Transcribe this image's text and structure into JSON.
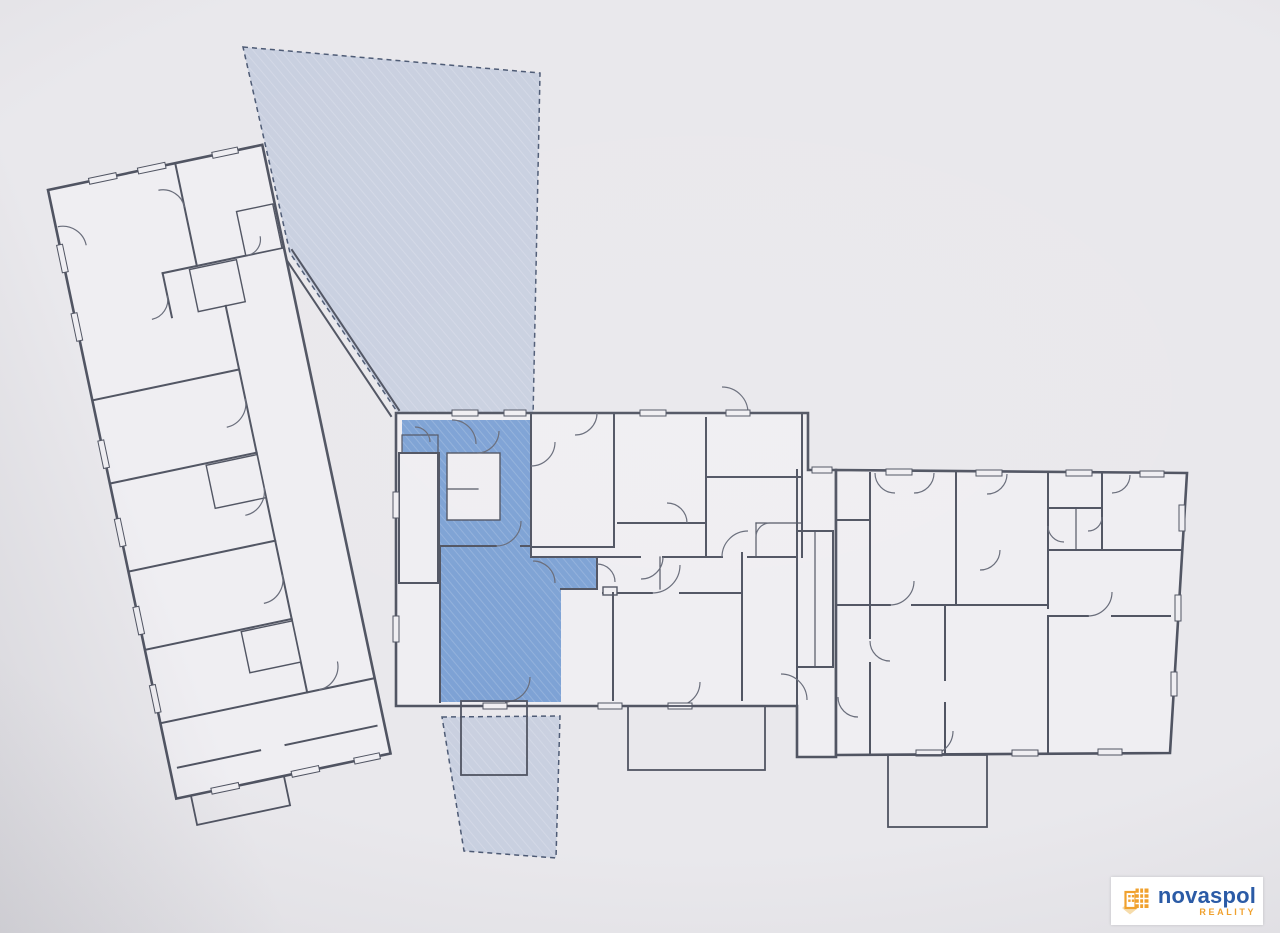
{
  "theme": {
    "paper": "#e9e8ec",
    "room": "#efeef2",
    "wall": "#4f5361",
    "wall_light": "#676b79",
    "highlight": "#7ca1d4",
    "highlight_mid": "#a6bcdd",
    "garden": "#c9d0e0",
    "garden_border": "#4d5a74",
    "logo_blue": "#2b5ba6",
    "logo_orange": "#f0a12e",
    "logo_diamond": "#f6dcab",
    "logo_bg": "#ffffff"
  },
  "plan": {
    "kind": "building floor plan, photographed print",
    "highlighted_unit": "apartment unit highlighted in blue with hatched fill",
    "outdoor_areas": "two light-blue dashed garden parcels belonging to the highlighted unit",
    "wings": [
      "left-wing",
      "central-block",
      "right-wing"
    ],
    "staircases": 2
  },
  "logo": {
    "name": "novaspol",
    "tagline": "REALITY"
  }
}
